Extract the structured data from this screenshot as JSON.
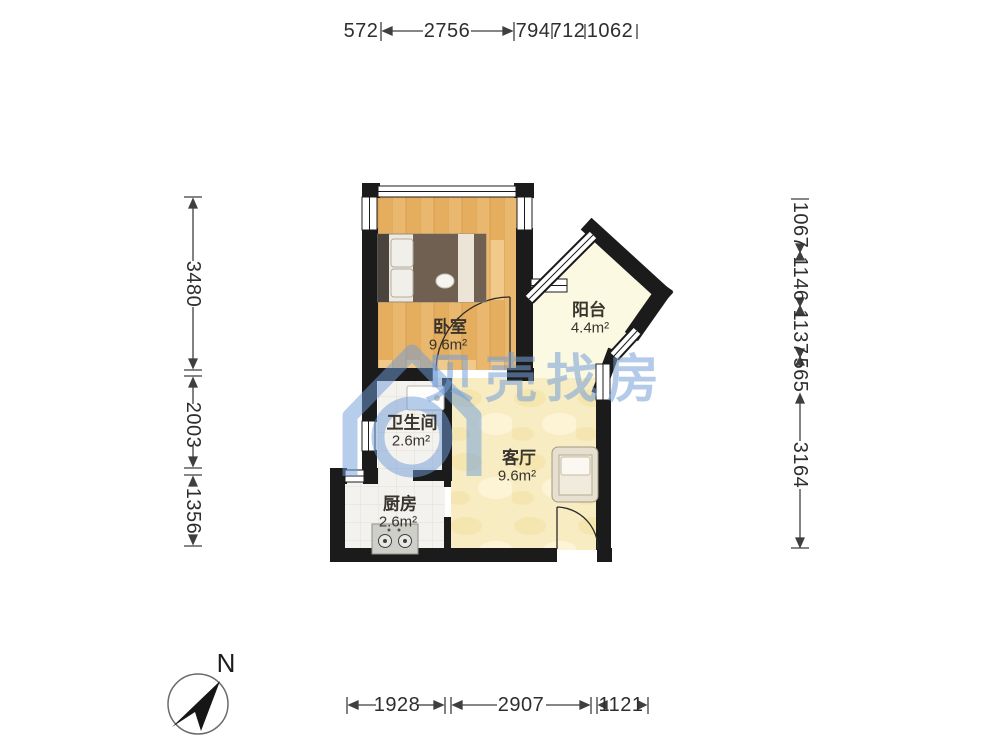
{
  "floorplan": {
    "watermark": {
      "text": "贝壳找房",
      "logo": "beike-house-icon",
      "color": "#76a0d8"
    },
    "compass": {
      "label": "N"
    },
    "rooms": [
      {
        "id": "bedroom",
        "name": "卧室",
        "area": "9.6m²"
      },
      {
        "id": "balcony",
        "name": "阳台",
        "area": "4.4m²"
      },
      {
        "id": "bathroom",
        "name": "卫生间",
        "area": "2.6m²"
      },
      {
        "id": "living",
        "name": "客厅",
        "area": "9.6m²"
      },
      {
        "id": "kitchen",
        "name": "厨房",
        "area": "2.6m²"
      }
    ],
    "dimensions_mm": {
      "top": [
        "572",
        "2756",
        "794",
        "712",
        "1062"
      ],
      "left": [
        "3480",
        "2003",
        "1356"
      ],
      "right": [
        "1067",
        "1146",
        "1137",
        "565",
        "3164"
      ],
      "bottom": [
        "1928",
        "2907",
        "1121"
      ]
    },
    "colors": {
      "wall": "#1b1b1b",
      "wood_floor": "#eec27e",
      "tile_floor": "#f3f2ee",
      "living_floor": "#f8edc2",
      "balcony_floor": "#fcf9e3",
      "dimension_text": "#2e2e2e",
      "watermark": "#76a0d8"
    }
  }
}
